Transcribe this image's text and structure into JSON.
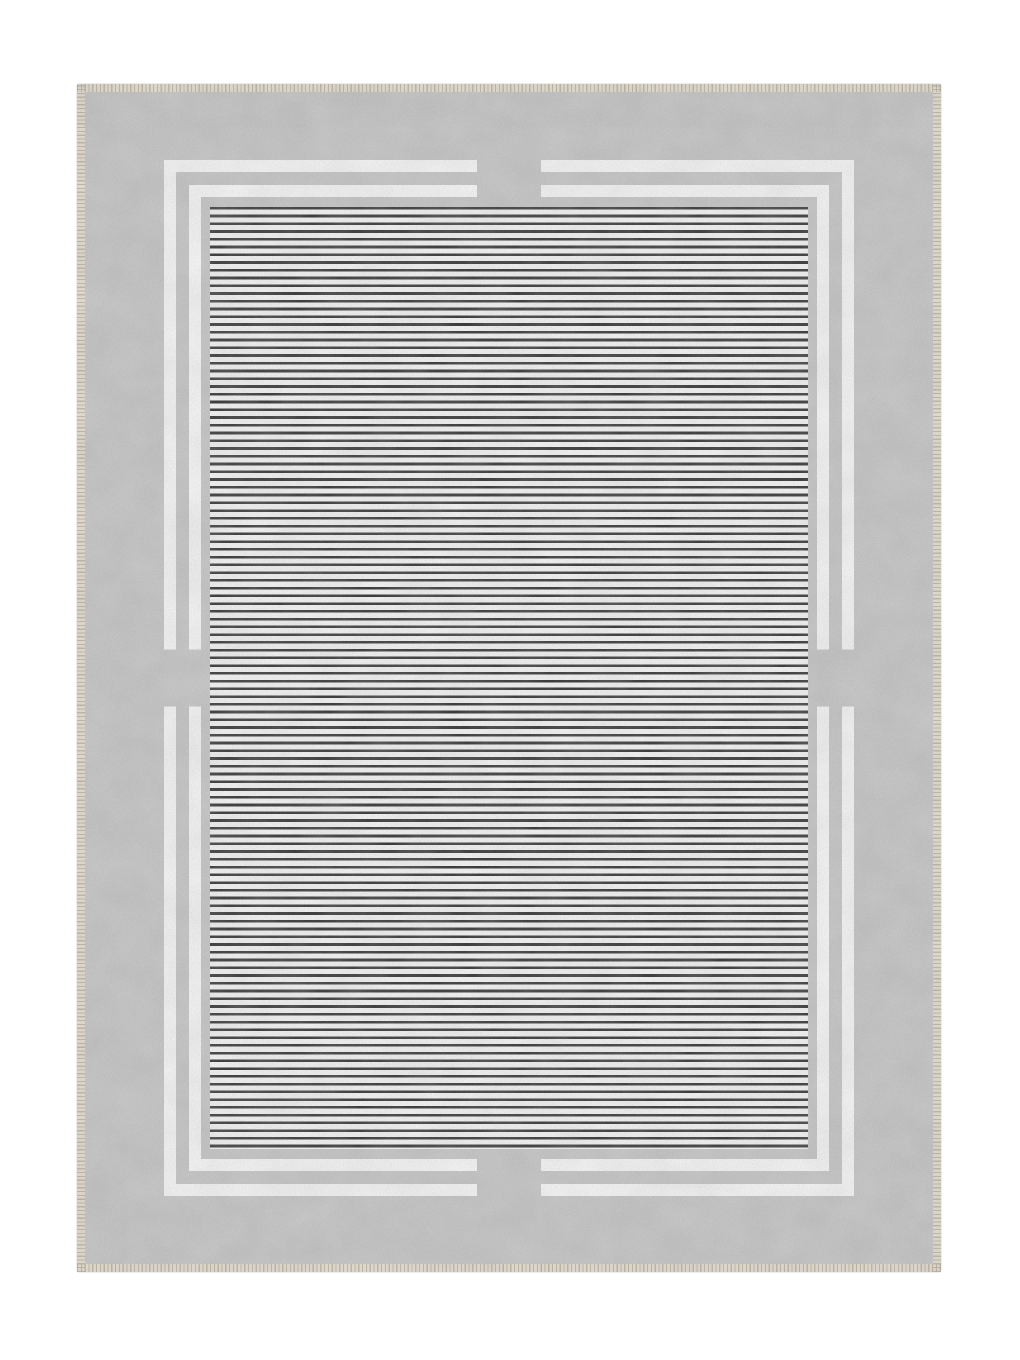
{
  "meta": {
    "type": "product-photo",
    "subject": "rectangular area rug on white background"
  },
  "colors": {
    "page-bg": "#ffffff",
    "fringe-cream": "#eae3d5",
    "stitch-brown": "#b7ac96",
    "border-gray": "#c7c7c7",
    "line-white": "#fdfdfd",
    "field-white": "#fbfbfb",
    "stripe-dark": "#2b2b2b"
  },
  "rug": {
    "description": "Gray mottled border rug with cream stitched selvage edge, two concentric white frame lines interrupted by gray tabs at the midpoint of each side, and a black-on-white horizontal pinstripe center panel",
    "border_texture": "feathery mottled gray",
    "frame_lines": 2,
    "side_tabs": 4,
    "stripe_orientation": "horizontal"
  }
}
